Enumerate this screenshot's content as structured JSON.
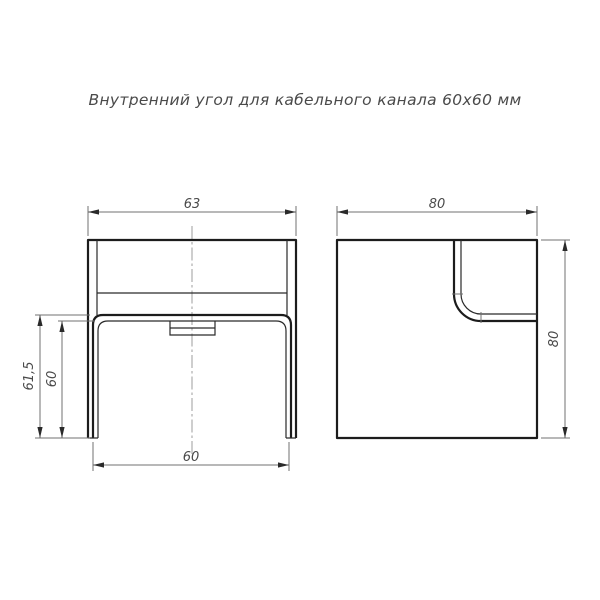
{
  "title": "Внутренний угол для кабельного канала 60х60 мм",
  "views": {
    "front": {
      "dims": {
        "top_width": "63",
        "outer_height": "61,5",
        "inner_height": "60",
        "bottom_width": "60"
      }
    },
    "side": {
      "dims": {
        "width": "80",
        "height": "80"
      }
    }
  },
  "colors": {
    "background": "#ffffff",
    "contour": "#1c1c1c",
    "dimension_lines": "#707070",
    "text": "#4a4a4a"
  }
}
